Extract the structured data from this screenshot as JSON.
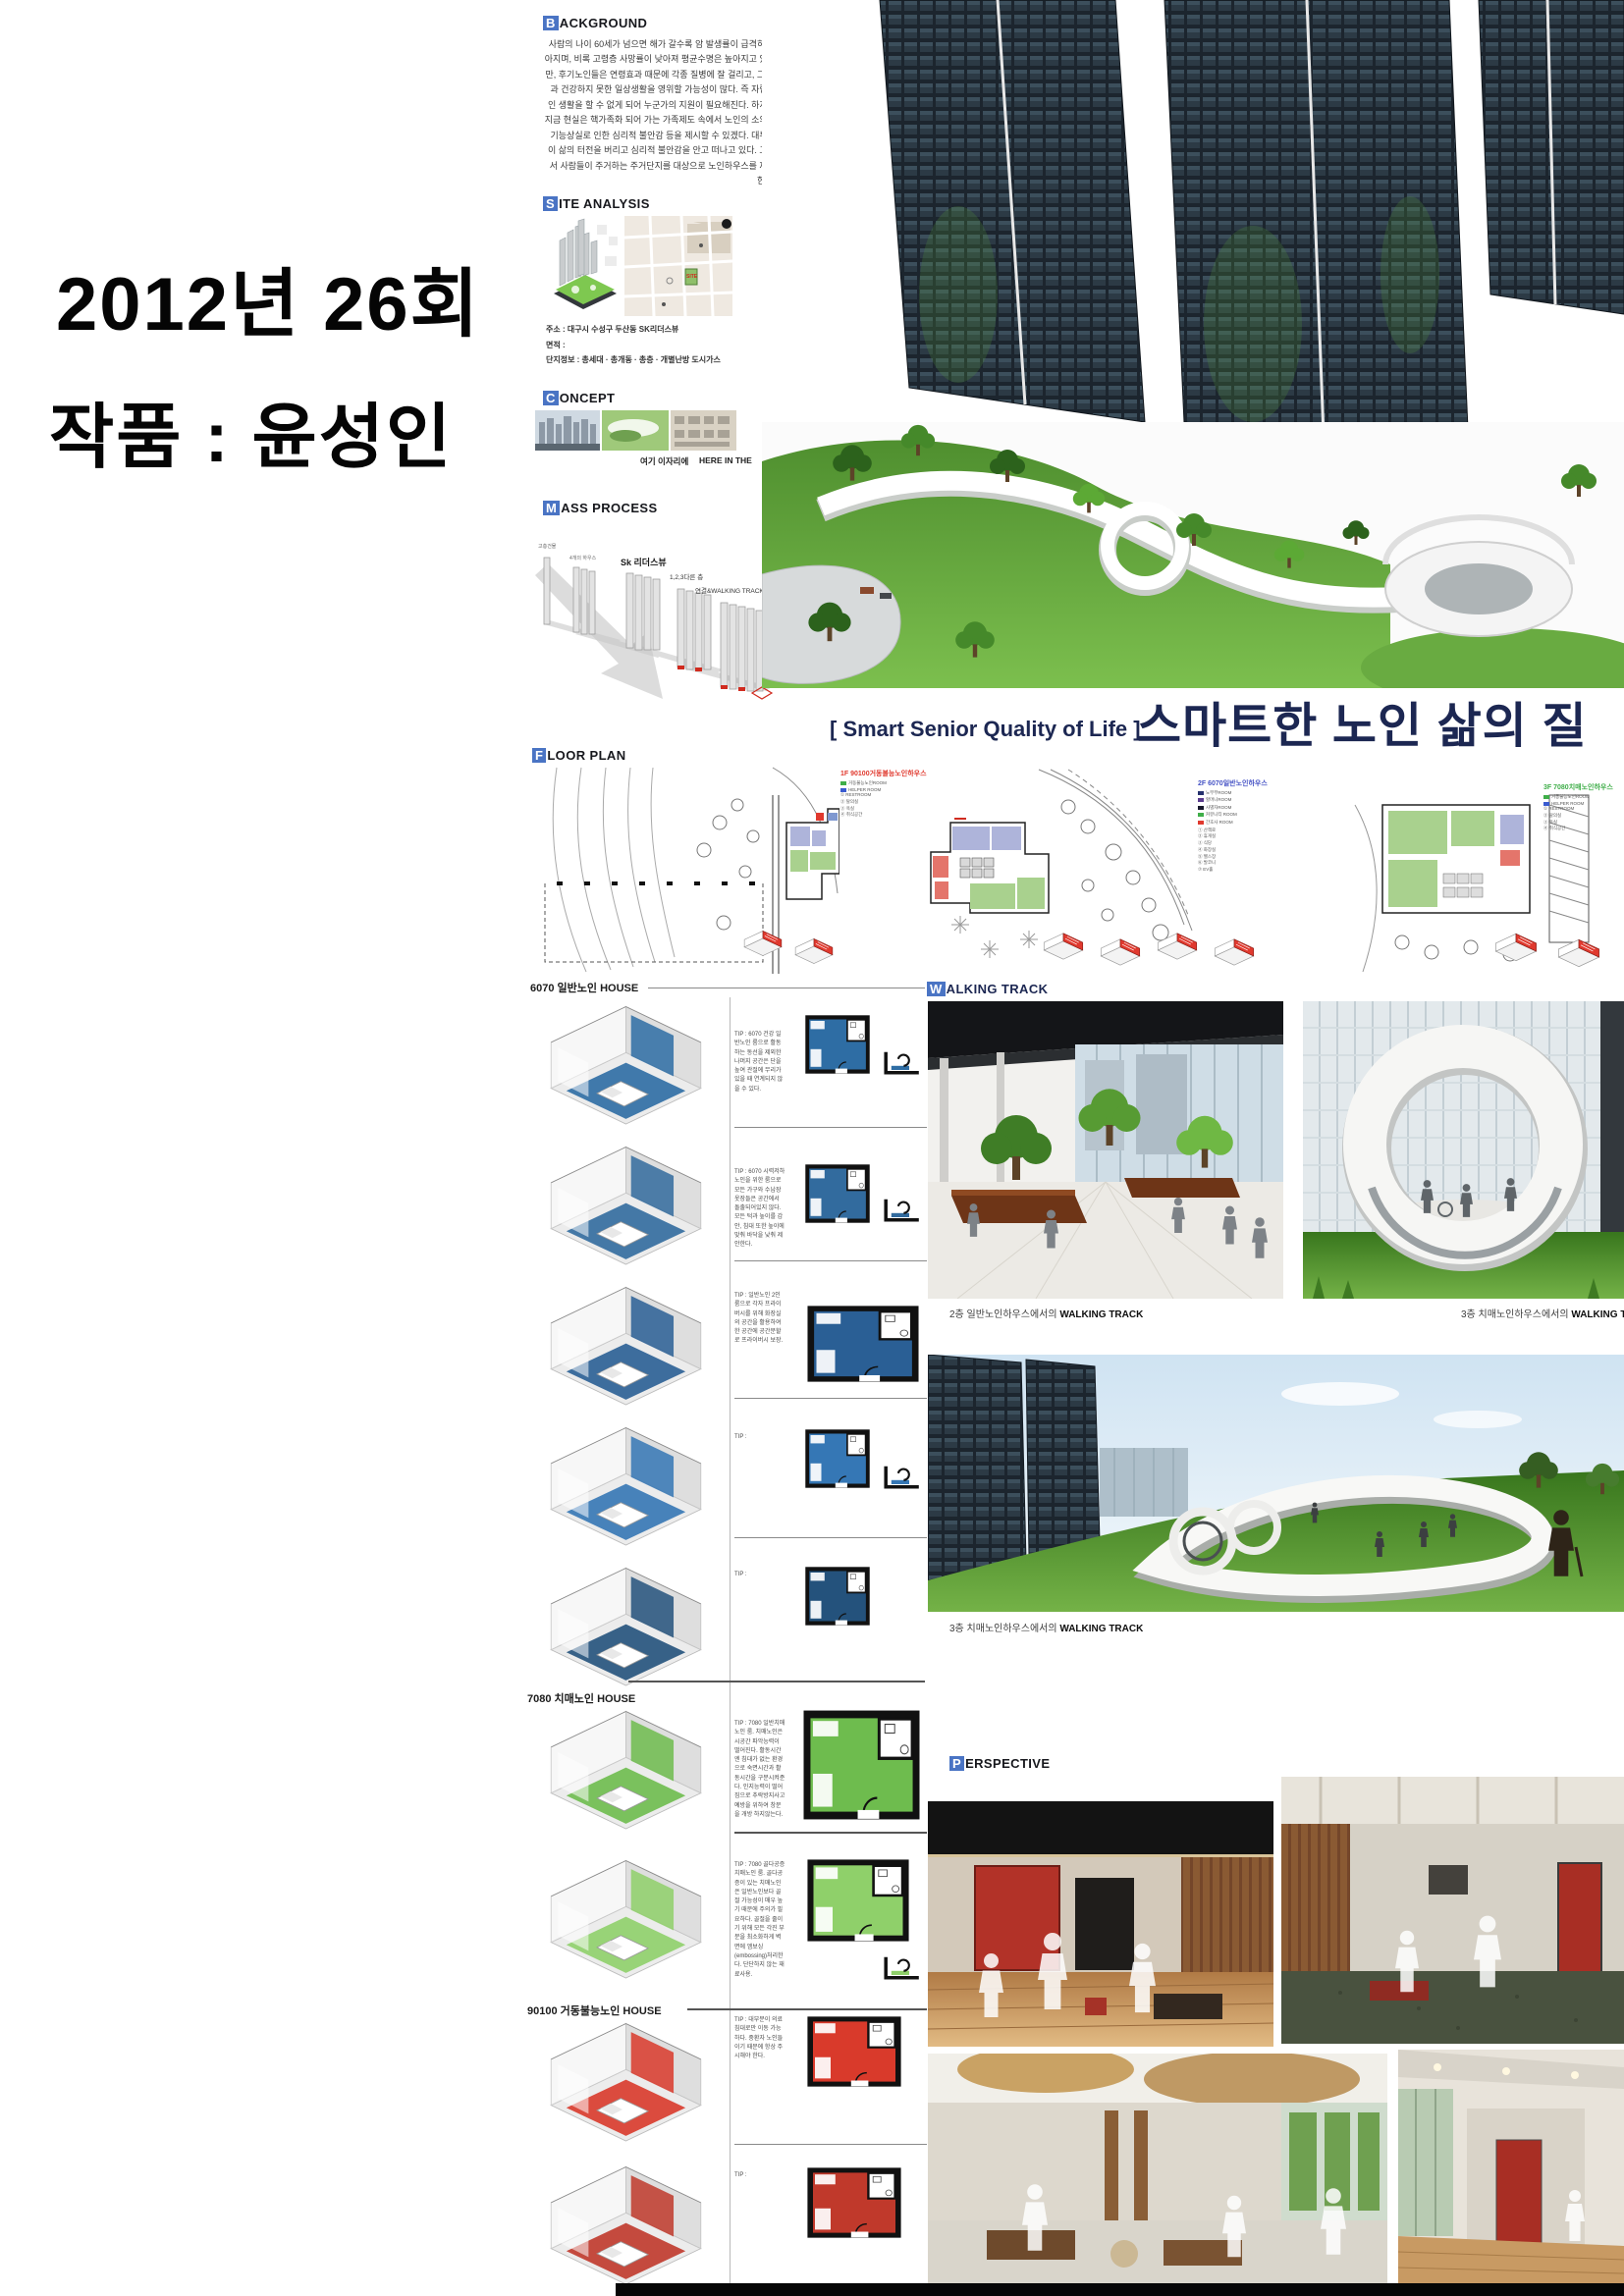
{
  "left_margin": {
    "line1": "2012년 26회",
    "line2": "작품 : 윤성인"
  },
  "title": {
    "sub": "[ Smart Senior Quality of Life ]",
    "main": "스마트한 노인 삶의 질"
  },
  "headers": {
    "background": {
      "cap": "B",
      "rest": "ACKGROUND"
    },
    "site": {
      "cap": "S",
      "rest": "ITE ANALYSIS"
    },
    "concept": {
      "cap": "C",
      "rest": "ONCEPT"
    },
    "mass": {
      "cap": "M",
      "rest": "ASS PROCESS"
    },
    "floor": {
      "cap": "F",
      "rest": "LOOR PLAN"
    },
    "walking": {
      "cap": "W",
      "rest": "ALKING TRACK"
    },
    "perspective": {
      "cap": "P",
      "rest": "ERSPECTIVE"
    }
  },
  "background_body": "사람의 나이 60세가 넘으면 해가 갈수록 암 발생률이 급격히 높아지며, 비록 고령층 사망률이 낮아져 평균수명은 높아지고 있지만, 후기노인들은 연령효과 때문에 각종 질병에 잘 걸리고, 그 결과 건강하지 못한 일상생활을 영위할 가능성이 많다. 즉 자립적인 생활을 할 수 없게 되어 누군가의 지원이 필요해진다. 하지만 지금 현실은 핵가족화 되어 가는 가족제도 속에서 노인의 소외와 기능상실로 인한 심리적 불안감 등을 제시할 수 있겠다. 대부분이 삶의 터전을 버리고 심리적 불안감을 안고 떠나고 있다. 그래서 사람들이 주거하는 주거단지를 대상으로 노인하우스를 제안한다.",
  "site": {
    "lines": [
      "주소 : 대구시 수성구 두산동 SK리더스뷰",
      "면적 :",
      "단지정보 : 총세대 · 총개동 · 총층 · 개별난방 도시가스"
    ]
  },
  "concept": {
    "caption_ko": "여기 이자리에",
    "caption_en": "HERE IN THE"
  },
  "mass": {
    "labels": [
      "고층건물",
      "4개의 하우스",
      "Sk 리더스뷰",
      "1,2,3다른 층",
      "연결&WALKING TRACK"
    ]
  },
  "floor_plans": [
    {
      "floor": "1F",
      "name": "90100거동불능노인하우스",
      "color": "#e0392e",
      "legend": [
        {
          "color": "#3fae49",
          "label": "거동불능노인ROOM"
        },
        {
          "color": "#3a5bd0",
          "label": "HELPER ROOM"
        }
      ],
      "notes": [
        "① RESTROOM",
        "② 탈의실",
        "③ 욕실",
        "④ 취식공간"
      ]
    },
    {
      "floor": "2F",
      "name": "6070일반노인하우스",
      "color": "#4653c5",
      "legend": [
        {
          "color": "#25316e",
          "label": "노부부ROOM"
        },
        {
          "color": "#5a3b8e",
          "label": "할머니ROOM"
        },
        {
          "color": "#17172b",
          "label": "사별자ROOM"
        },
        {
          "color": "#3fae49",
          "label": "커뮤니티 ROOM"
        },
        {
          "color": "#e0392e",
          "label": "간호사 ROOM"
        }
      ],
      "notes": [
        "① 산책로",
        "② 휴게실",
        "③ 식당",
        "④ 화장실",
        "⑤ 헬스장",
        "⑥ 발코니",
        "⑦ EV홀"
      ]
    },
    {
      "floor": "3F",
      "name": "7080치매노인하우스",
      "color": "#3fae49",
      "legend": [
        {
          "color": "#3fae49",
          "label": "거동불능노인ROOM"
        },
        {
          "color": "#3a5bd0",
          "label": "HELPER ROOM"
        }
      ],
      "notes": [
        "① RESTROOM",
        "② 탈의실",
        "③ 욕실",
        "④ 취식공간"
      ]
    }
  ],
  "units": {
    "groups": [
      {
        "header": "6070 일반노인 HOUSE",
        "accent": "#2e6da4",
        "items": [
          {
            "c": "#2e6da4",
            "tip": "TIP : 6070 건강 일반노인 룸으로 활동하는 동선을 제외한 나머지 공간은 단을 높여 관절에 무리가 있을 때 연계되지 않을 수 있다."
          },
          {
            "c": "#326b9e",
            "tip": "TIP : 6070 시력저하 노인을 위한 룸으로 모든 가구와 수납장 옷장들은 공간에서 돌출되어있지 않다. 모든 턱과 높이를 감안, 침대 또한 높이에 맞춰 바닥을 낮춰 제안한다."
          },
          {
            "c": "#2a5f95",
            "tip": "TIP : 일반노인 2인 룸으로 각자 프라이버시를 위해 화장실의 공간을 활용하여 한 공간에 공간분할로 프라이버시 보장."
          },
          {
            "c": "#3577b5",
            "tip": "TIP :"
          },
          {
            "c": "#24527c",
            "tip": "TIP :"
          }
        ]
      },
      {
        "header": "7080 치매노인 HOUSE",
        "accent": "#6ebc4e",
        "items": [
          {
            "c": "#6ebc4e",
            "tip": "TIP : 7080 일반치매노인 룸. 치매노인은 시공간 파악능력이 떨어진다. 활동시간엔 침대가 없는 환경으로 숙면시간과 활동시간을 구분시켜준다. 인지능력이 떨어짐으로 추락방지사고 예방을 위하여 창문을 개방 하지않는다."
          },
          {
            "c": "#8fd06a",
            "tip": "TIP : 7080 골다공증 치매노인 룸. 골다공증이 있는 치매노인은 일반노인보다 골절 가능성이 매우 높기 때문에 주의가 필요하다. 골절을 줄이기 위해 모든 각진 부분을 최소화하게 벽면에 엠보싱(embossing)처리한다. 단단하지 않는 재료사용."
          }
        ]
      },
      {
        "header": "90100 거동불능노인 HOUSE",
        "accent": "#d93a2b",
        "items": [
          {
            "c": "#d93a2b",
            "tip": "TIP : 대부분이 의료침대로만 이동 가능하다. 중환자 노인들이기 때문에 항상 주시해야 한다."
          },
          {
            "c": "#c0392b",
            "tip": "TIP :"
          }
        ]
      }
    ]
  },
  "walking": {
    "captions": [
      {
        "pre": "2층 일반노인하우스에서의 ",
        "strong": "WALKING TRACK"
      },
      {
        "pre": "3층 치매노인하우스에서의 ",
        "strong": "WALKING T"
      },
      {
        "pre": "3층 치매노인하우스에서의 ",
        "strong": "WALKING TRACK"
      }
    ]
  },
  "colors": {
    "navy": "#1c2752",
    "header_box": "#4a74c4",
    "black_bar": "#060606"
  }
}
